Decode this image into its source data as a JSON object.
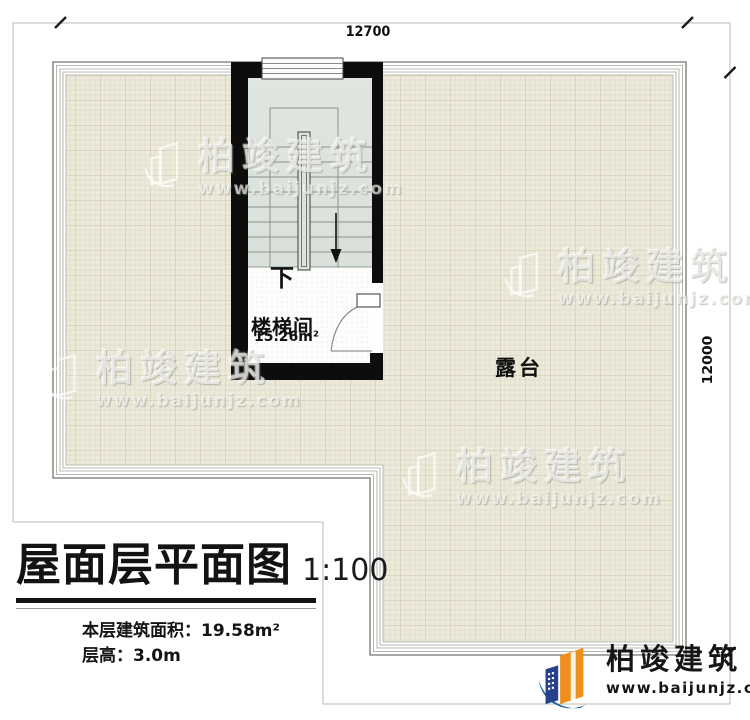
{
  "plan": {
    "dimensions": {
      "top": "12700",
      "right": "12000"
    },
    "labels": {
      "stairwell": "楼梯间",
      "stairwell_area": "15.26m²",
      "down": "下",
      "terrace": "露台"
    },
    "scale_note": "1:100"
  },
  "title_block": {
    "title": "屋面层平面图",
    "scale": "1:100",
    "area_line": "本层建筑面积：19.58m²",
    "height_line": "层高：3.0m"
  },
  "watermark": {
    "name": "柏竣建筑",
    "url": "www.baijunjz.com"
  },
  "logo": {
    "name": "柏竣建筑",
    "url": "www.baijunjz.com"
  },
  "colors": {
    "terrace_fill": "#edeadb",
    "terrace_grid": "#e0dcc8",
    "stair_fill": "#dde3da",
    "wall": "#0d0d0d",
    "brand_orange": "#ef8f1f",
    "brand_blue": "#1d5ca5",
    "frame_gray": "#b9b9b3"
  }
}
